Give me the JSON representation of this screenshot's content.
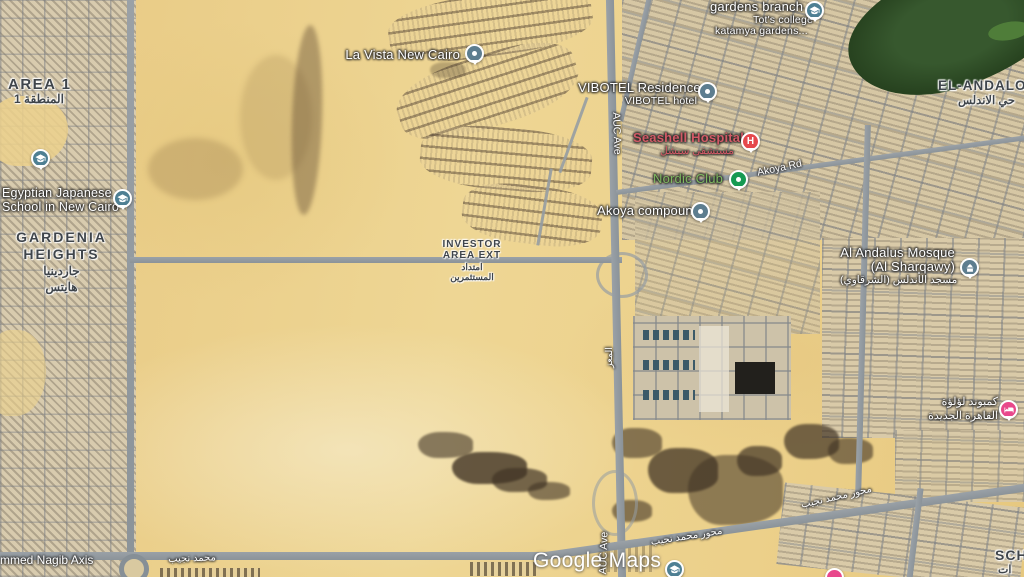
{
  "map": {
    "watermark": "Google Maps",
    "districts": {
      "area1": {
        "name": "AREA 1",
        "name_ar": "المنطقة 1"
      },
      "gardenia_heights": {
        "line1": "GARDENIA",
        "line2": "HEIGHTS",
        "ar1": "جاردينيا",
        "ar2": "هايتس"
      },
      "el_andalos": {
        "name": "EL-ANDALOS",
        "name_ar": "حي الاندلس"
      },
      "investor_area_ext": {
        "line1": "INVESTOR",
        "line2": "AREA EXT",
        "ar1": "امتداد",
        "ar2": "المستثمرين"
      },
      "sch": {
        "name": "SCH",
        "name_ar": "ات"
      }
    },
    "pois": {
      "la_vista": {
        "label": "La Vista New Cairo"
      },
      "vibotel": {
        "label": "VIBOTEL Residence",
        "sublabel": "VIBOTEL hotel"
      },
      "seashell_hospital": {
        "label": "Seashell Hospital",
        "sublabel_ar": "مستشفى سيشل",
        "icon_letter": "H"
      },
      "nordic_club": {
        "label": "Nordic Club"
      },
      "akoya_compound": {
        "label": "Akoya compound"
      },
      "gardens_branch": {
        "line1": "gardens branch",
        "line2": "Tot's college",
        "line3": "katamya gardens..."
      },
      "al_andalus_mosque": {
        "line1": "Al Andalus Mosque",
        "line2": "(Al Sharqawy)",
        "sublabel_ar": "مسجد الأندلس (الشرقاوي)"
      },
      "egyptian_japanese_school": {
        "line1": "Egyptian Japanese",
        "line2": "School in New Cairo"
      },
      "lulua_compound": {
        "ar1": "كمبوند لؤلؤة",
        "ar2": "القاهرة الجديدة"
      }
    },
    "roads": {
      "akoya_rd": "Akoya Rd",
      "auc_ave_north": "AUC Ave",
      "auc_ave_south": "AUC Ave",
      "al_muizz_ar": "المعز",
      "nagib_axis": "mmed Nagib Axis",
      "nagib_axis_ar": "محمد نجيب",
      "mehwar_nagib_ar_south": "محور محمد نجيب",
      "mehwar_nagib_ar_east": "محور محمد نجيب"
    },
    "colors": {
      "hospital_red": "#e5484d",
      "hospital_label": "#d15a66",
      "park_green": "#169a52",
      "park_label": "#7fb860",
      "poi_pin_slate": "#5d7d8f",
      "school_pin_teal": "#4e7f93",
      "lodging_pink": "#e8488b"
    }
  }
}
